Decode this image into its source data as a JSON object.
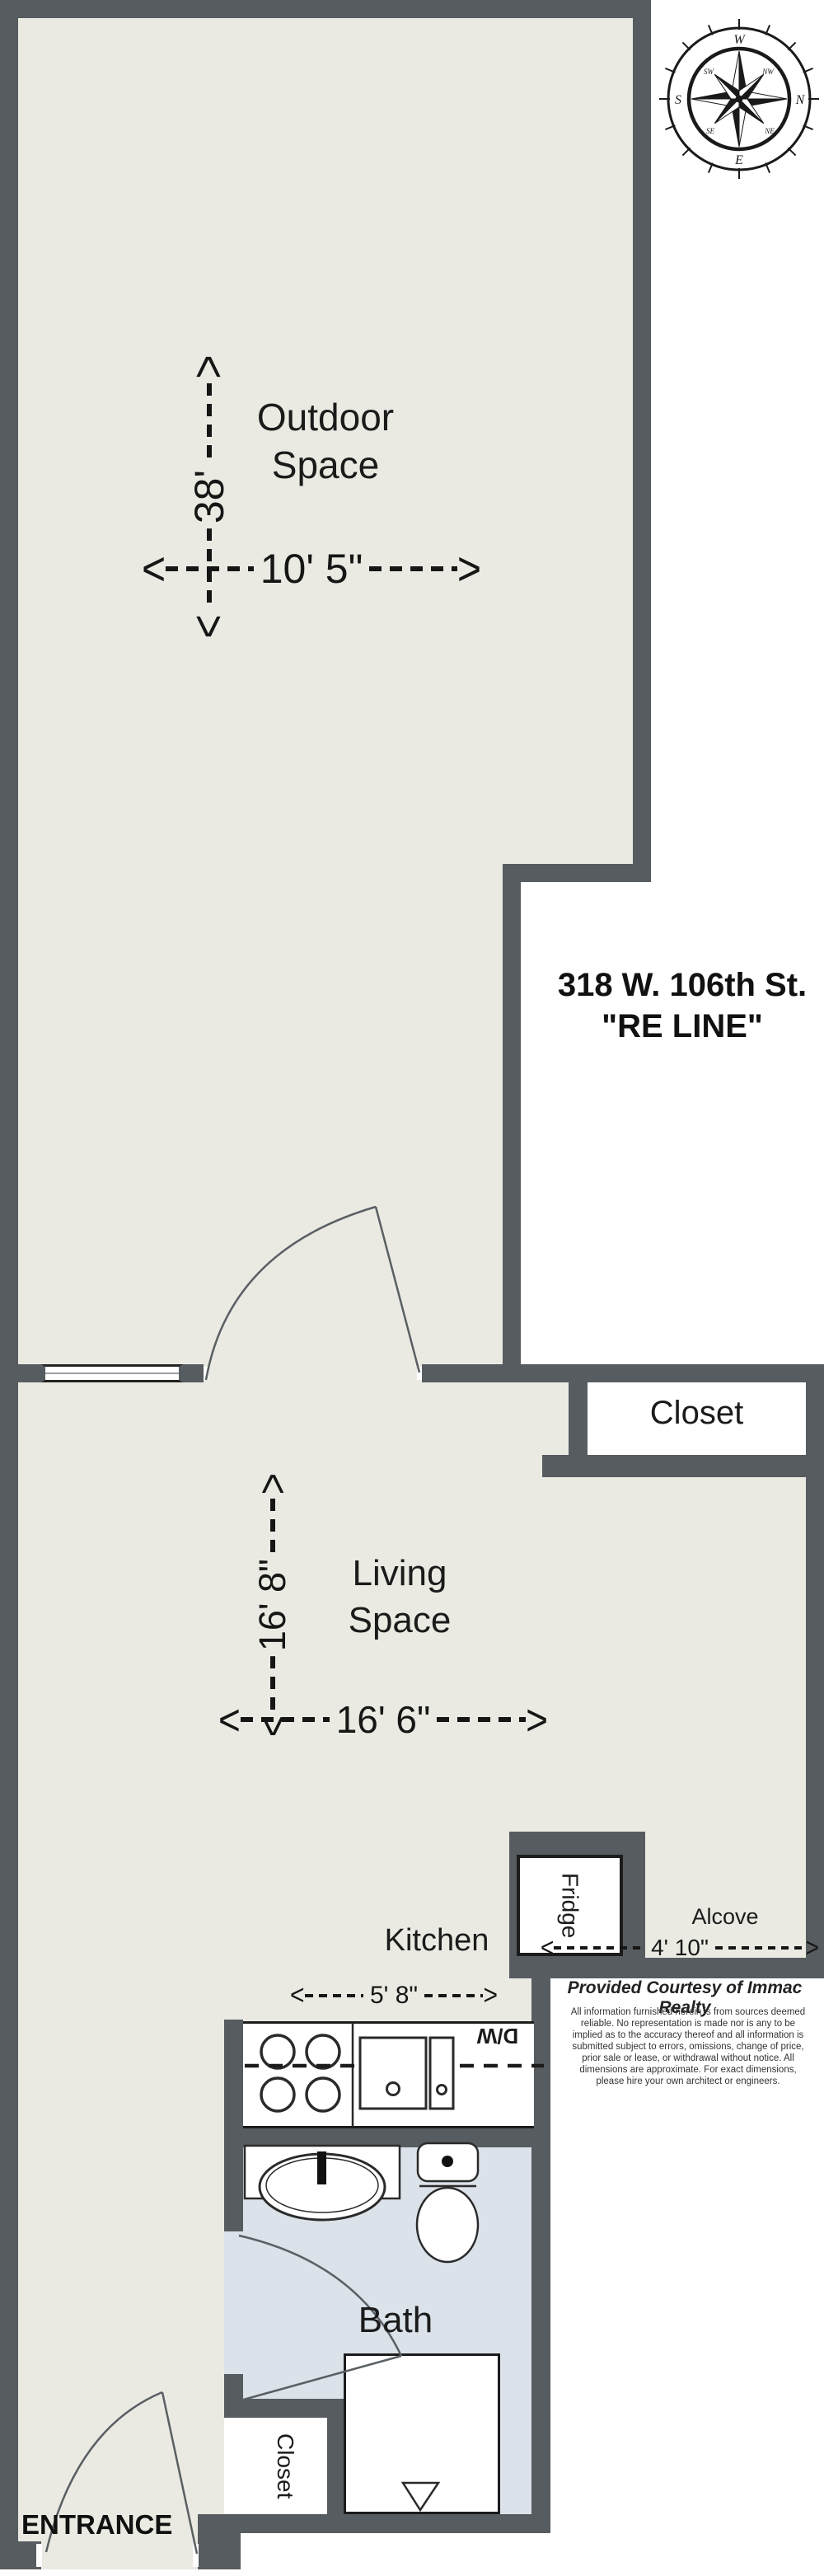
{
  "plan": {
    "address_line1": "318 W. 106th St.",
    "address_line2": "\"RE LINE\"",
    "entrance_label": "ENTRANCE",
    "courtesy": "Provided Courtesy of Immac Realty",
    "disclaimer": "All information furnished herein is from sources deemed reliable. No representation is made nor is any to be implied as to the accuracy thereof and all information is submitted subject to errors, omissions, change of price, prior sale or lease, or withdrawal without notice. All dimensions are approximate. For exact dimensions, please hire your own architect or engineers."
  },
  "rooms": {
    "outdoor": {
      "name_line1": "Outdoor",
      "name_line2": "Space",
      "width": "10' 5\"",
      "height": "38'"
    },
    "living": {
      "name_line1": "Living",
      "name_line2": "Space",
      "width": "16' 6\"",
      "height": "16' 8\""
    },
    "kitchen": {
      "name": "Kitchen",
      "width": "5' 8\""
    },
    "alcove": {
      "name": "Alcove",
      "width": "4' 10\""
    },
    "closet": {
      "name": "Closet"
    },
    "bath": {
      "name": "Bath"
    },
    "bath_closet": {
      "name": "Closet"
    }
  },
  "fixtures": {
    "fridge": "Fridge",
    "dishwasher": "D/W"
  },
  "dim_arrows": {
    "left": "<",
    "right": ">",
    "up": "<",
    "down": ">"
  },
  "compass": {
    "top": "W",
    "right": "N",
    "bottom": "E",
    "left": "S",
    "top_right": "NW",
    "bottom_right": "NE",
    "bottom_left": "SE",
    "top_left": "SW"
  },
  "colors": {
    "wall": "#575c60",
    "floor": "#eaeae3",
    "bath_floor": "#dce2e9",
    "outline": "#1c1c1c"
  }
}
